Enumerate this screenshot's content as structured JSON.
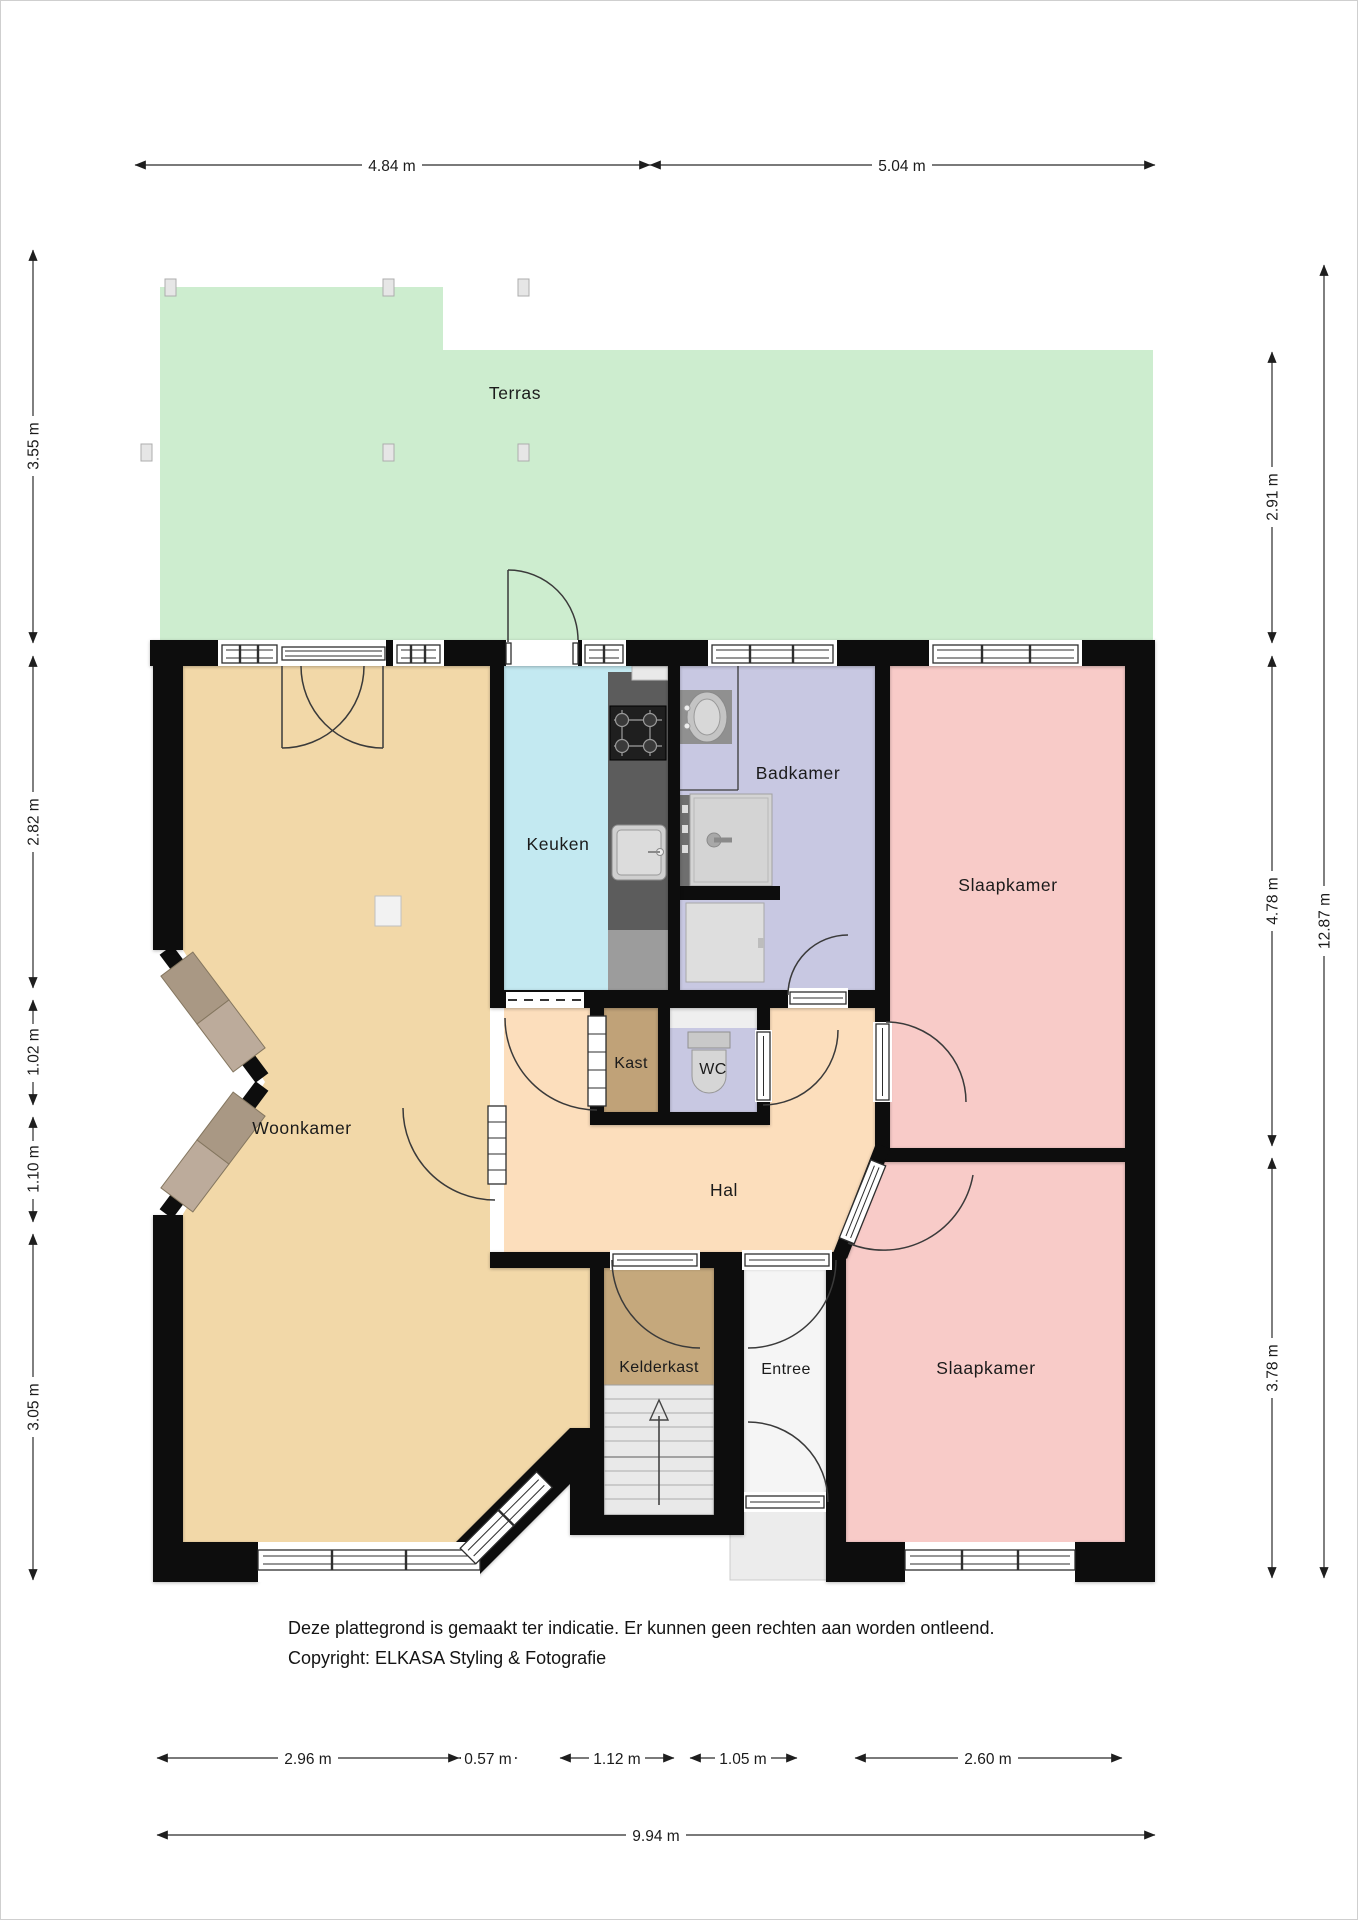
{
  "rooms": {
    "terras": "Terras",
    "woonkamer": "Woonkamer",
    "keuken": "Keuken",
    "badkamer": "Badkamer",
    "slaapkamer_boven": "Slaapkamer",
    "kast": "Kast",
    "wc": "WC",
    "hal": "Hal",
    "kelderkast": "Kelderkast",
    "entree": "Entree",
    "slaapkamer_onder": "Slaapkamer"
  },
  "dimensions": {
    "top": [
      "4.84 m",
      "5.04 m"
    ],
    "left": [
      "3.55 m",
      "2.82 m",
      "1.02 m",
      "1.10 m",
      "3.05 m"
    ],
    "right": [
      "2.91 m",
      "4.78 m",
      "3.78 m"
    ],
    "right_total": "12.87 m",
    "bottom": [
      "2.96 m",
      "0.57 m",
      "1.12 m",
      "1.05 m",
      "2.60 m"
    ],
    "bottom_total": "9.94 m"
  },
  "footer": {
    "disclaimer": "Deze plattegrond is gemaakt ter indicatie. Er kunnen geen rechten aan worden ontleend.",
    "copyright": "Copyright: ELKASA Styling & Fotografie"
  },
  "colors": {
    "terras": "#cdedcf",
    "woonkamer": "#f2d8a8",
    "keuken": "#c3e9f1",
    "badkamer": "#c8c8e2",
    "slaapkamer": "#f8cbc8",
    "hal": "#fcdebc",
    "kast": "#c0a278",
    "kelderkast": "#c5a87c",
    "entree": "#f5f5f5",
    "wall": "#0d0d0d"
  }
}
